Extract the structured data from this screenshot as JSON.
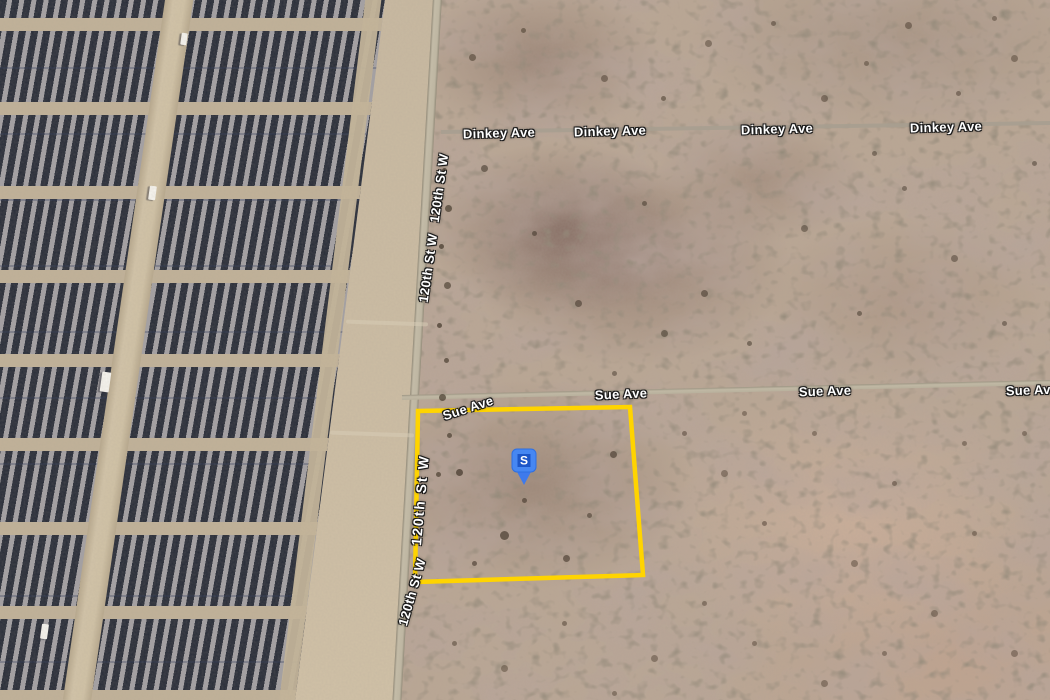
{
  "map": {
    "description": "Aerial satellite view of a desert parcel next to a large solar farm",
    "road_labels": [
      {
        "name": "dinkey-ave-1",
        "text": "Dinkey Ave"
      },
      {
        "name": "dinkey-ave-2",
        "text": "Dinkey Ave"
      },
      {
        "name": "dinkey-ave-3",
        "text": "Dinkey Ave"
      },
      {
        "name": "dinkey-ave-4",
        "text": "Dinkey Ave"
      },
      {
        "name": "sue-ave-1",
        "text": "Sue Ave"
      },
      {
        "name": "sue-ave-2",
        "text": "Sue Ave"
      },
      {
        "name": "sue-ave-3",
        "text": "Sue Ave"
      },
      {
        "name": "sue-ave-4",
        "text": "Sue Ave"
      },
      {
        "name": "120th-st-w-1",
        "text": "120th St W"
      },
      {
        "name": "120th-st-w-2",
        "text": "120th St W"
      },
      {
        "name": "120th-st-w-3",
        "text": "120th St W"
      },
      {
        "name": "120th-st-w-4",
        "text": "120th St W"
      }
    ],
    "marker": {
      "label": "S",
      "color": "#4687f2",
      "inner_color": "#1c56c8",
      "tail_color": "#3e7aec"
    },
    "parcel": {
      "outline_color": "#ffd400"
    }
  }
}
